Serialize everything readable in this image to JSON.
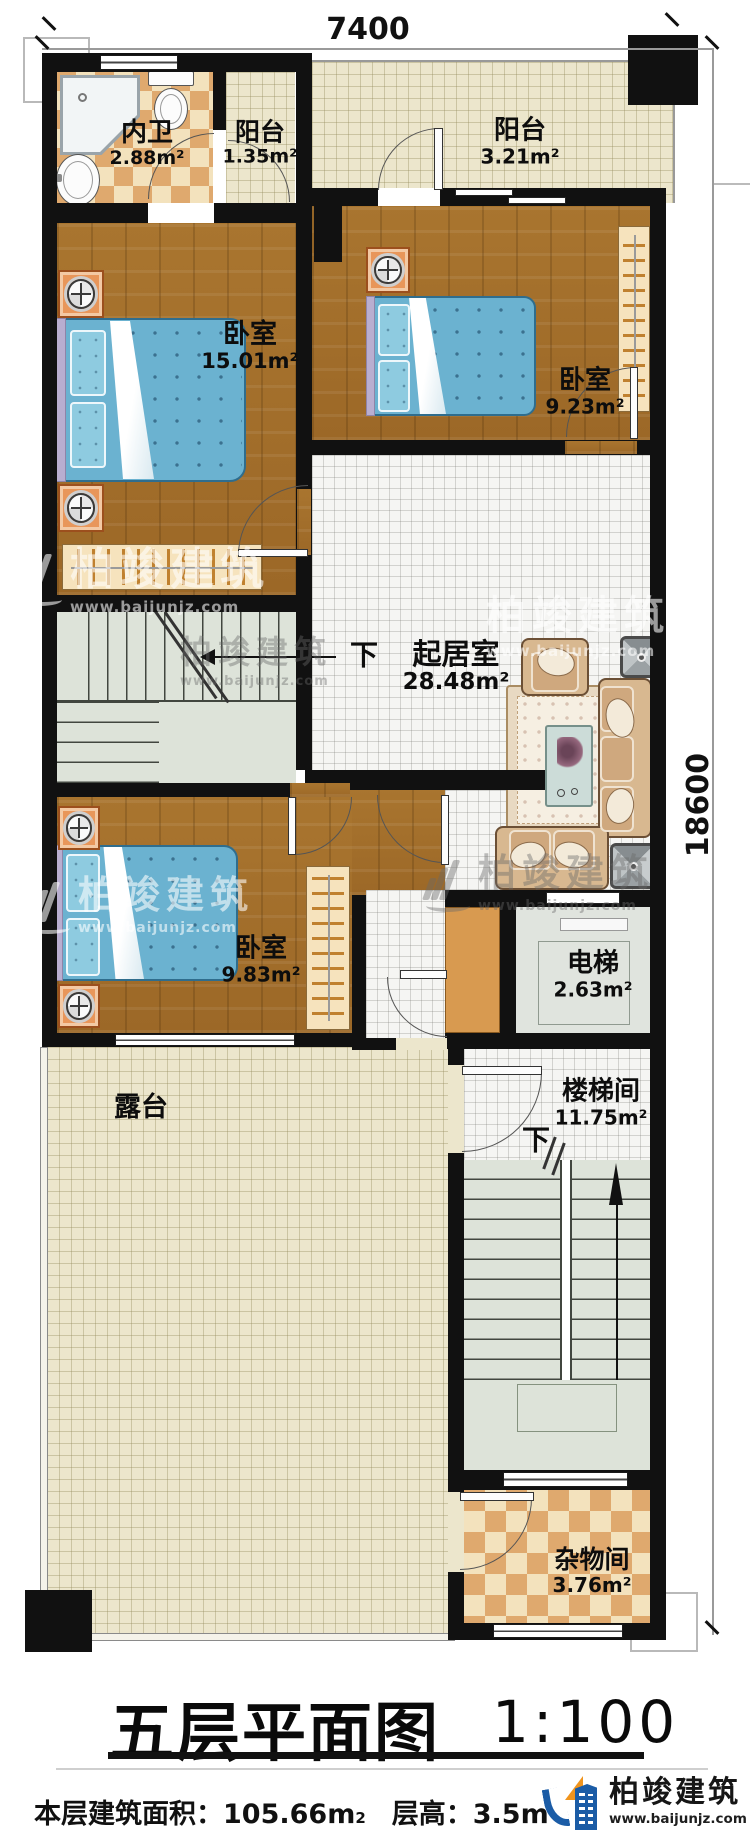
{
  "page": {
    "type": "architectural-floor-plan"
  },
  "dimensions": {
    "top": "7400",
    "right": "18600"
  },
  "rooms": {
    "bathroom": {
      "name": "内卫",
      "area": "2.88m²"
    },
    "balcony1": {
      "name": "阳台",
      "area": "1.35m²"
    },
    "balcony2": {
      "name": "阳台",
      "area": "3.21m²"
    },
    "bedroom1": {
      "name": "卧室",
      "area": "15.01m²"
    },
    "bedroom2": {
      "name": "卧室",
      "area": "9.23m²"
    },
    "living": {
      "name": "起居室",
      "area": "28.48m²"
    },
    "bedroom3": {
      "name": "卧室",
      "area": "9.83m²"
    },
    "elevator": {
      "name": "电梯",
      "area": "2.63m²"
    },
    "stairwell": {
      "name": "楼梯间",
      "area": "11.75m²"
    },
    "terrace": {
      "name": "露台"
    },
    "storage": {
      "name": "杂物间",
      "area": "3.76m²"
    }
  },
  "markers": {
    "down_living": "下",
    "down_stairwell": "下"
  },
  "titleblock": {
    "title": "五层平面图",
    "scale": "1:100"
  },
  "footer": {
    "area_label": "本层建筑面积：",
    "area_value": "105.66m",
    "area_sup": "2",
    "height_label": "层高：",
    "height_value": "3.5m"
  },
  "brand": {
    "name": "柏竣建筑",
    "url": "www.baijunjz.com"
  },
  "colors": {
    "wall": "#111111",
    "wood": "#a9752f",
    "woodDark": "#9c6827",
    "bedBlue": "#6bb2d0",
    "tileBeige": "#ece6cc",
    "tileWhite": "#f5f5f3",
    "stairGreen": "#dde3d9",
    "checkerLight": "#f3e2bd",
    "checkerDark": "#dfa96e",
    "furnTan": "#d8b890",
    "logoBlue": "#1b5ca6",
    "logoOrange": "#f0941d",
    "accentOrange": "#e8965a"
  }
}
